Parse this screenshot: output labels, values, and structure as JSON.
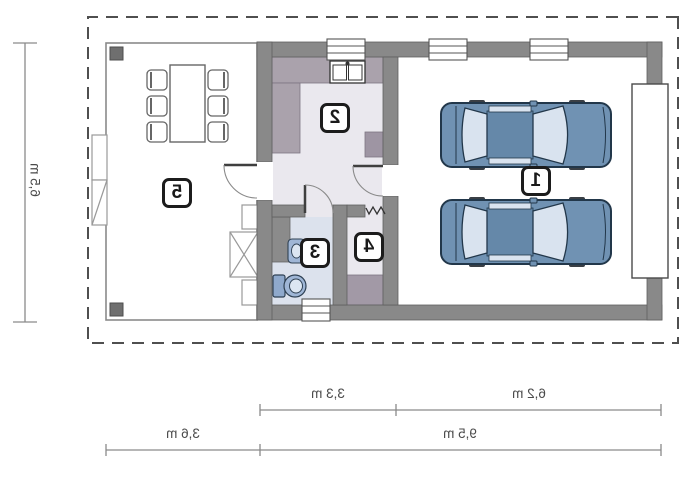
{
  "plan": {
    "title": "garage floor plan (mirrored print)",
    "room_labels": [
      {
        "id": "garage",
        "number": "1"
      },
      {
        "id": "kitchen",
        "number": "2"
      },
      {
        "id": "bathroom",
        "number": "3"
      },
      {
        "id": "hall",
        "number": "4"
      },
      {
        "id": "terrace",
        "number": "5"
      }
    ],
    "dimensions": {
      "building_depth": "6,5 m",
      "house_section_width": "3,3 m",
      "garage_section_width": "6,2 m",
      "terrace_width": "3,6 m",
      "total_width": "9,5 m"
    },
    "colors": {
      "wall": "#898989",
      "floor_main": "#eae8ee",
      "floor_bath": "#dce2ed",
      "counter": "#aaa2ac",
      "cabinet": "#a299a6",
      "car_body": "#7092b3",
      "car_glass": "#d9e3ef",
      "fixture_blue": "#9fb6d6"
    },
    "icons": [
      "car-icon",
      "dining-table-icon",
      "chair-icon",
      "toilet-icon",
      "washbasin-icon",
      "kitchen-sink-icon",
      "window-icon",
      "door-arc-icon",
      "garage-door",
      "steps-icon",
      "zigzag-opening-icon",
      "terrace-post"
    ]
  }
}
